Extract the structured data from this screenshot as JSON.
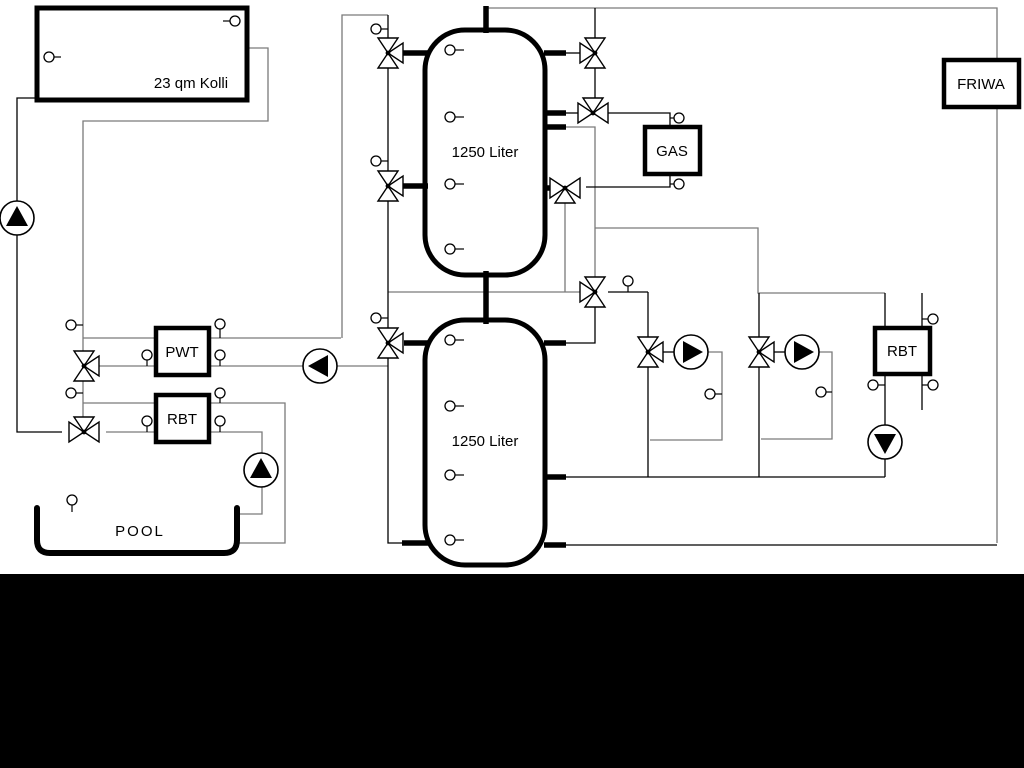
{
  "title": "Hydraulic scheme",
  "colors": {
    "black": "#000000",
    "gray": "#7a7a7a",
    "white": "#ffffff",
    "bar": "#000000"
  },
  "bottom_bar": {
    "x": 0,
    "y": 574,
    "w": 1024,
    "h": 194
  },
  "labels": {
    "collector": "23 qm Kolli",
    "tank1": "1250 Liter",
    "tank2": "1250 Liter",
    "gas": "GAS",
    "friwa": "FRIWA",
    "pwt": "PWT",
    "rbt_left": "RBT",
    "rbt_right": "RBT",
    "pool": "POOL"
  },
  "diagram": {
    "lines": [
      {
        "name": "solar-return-line",
        "color": "gray",
        "pts": [
          [
            247,
            48
          ],
          [
            268,
            48
          ],
          [
            268,
            121
          ],
          [
            83,
            121
          ],
          [
            83,
            418
          ]
        ]
      },
      {
        "name": "tank1-top-feed-line",
        "color": "gray",
        "pts": [
          [
            388,
            15
          ],
          [
            342,
            15
          ],
          [
            342,
            338
          ]
        ]
      },
      {
        "name": "pwt-top-line",
        "color": "gray",
        "pts": [
          [
            83,
            338
          ],
          [
            341,
            338
          ]
        ]
      },
      {
        "name": "pwt-bottom-line",
        "color": "gray",
        "pts": [
          [
            99,
            366
          ],
          [
            388,
            366
          ]
        ]
      },
      {
        "name": "rbt-top-line",
        "color": "gray",
        "pts": [
          [
            83,
            403
          ],
          [
            285,
            403
          ],
          [
            285,
            543
          ],
          [
            237,
            543
          ]
        ]
      },
      {
        "name": "rbt-bottom-pool-line",
        "color": "gray",
        "pts": [
          [
            106,
            432
          ],
          [
            262,
            432
          ],
          [
            262,
            514
          ],
          [
            238,
            514
          ]
        ]
      },
      {
        "name": "main-top-friwa-line",
        "color": "gray",
        "pts": [
          [
            486,
            8
          ],
          [
            997,
            8
          ],
          [
            997,
            543
          ]
        ]
      },
      {
        "name": "secondary-supply-line",
        "color": "gray",
        "pts": [
          [
            388,
            292
          ],
          [
            580,
            292
          ]
        ]
      },
      {
        "name": "gas-return-drop-line",
        "color": "gray",
        "pts": [
          [
            565,
            202
          ],
          [
            565,
            292
          ]
        ]
      },
      {
        "name": "tank1-right-drop-line",
        "color": "gray",
        "pts": [
          [
            566,
            127
          ],
          [
            595,
            127
          ],
          [
            595,
            278
          ]
        ]
      },
      {
        "name": "heating-branch-line",
        "color": "gray",
        "pts": [
          [
            595,
            228
          ],
          [
            758,
            228
          ],
          [
            758,
            293
          ],
          [
            885,
            293
          ]
        ]
      },
      {
        "name": "heating1-bypass-loop",
        "color": "gray",
        "pts": [
          [
            708,
            352
          ],
          [
            722,
            352
          ],
          [
            722,
            440
          ],
          [
            650,
            440
          ]
        ]
      },
      {
        "name": "heating2-bypass-loop",
        "color": "gray",
        "pts": [
          [
            819,
            352
          ],
          [
            832,
            352
          ],
          [
            832,
            439
          ],
          [
            761,
            439
          ]
        ]
      },
      {
        "name": "solar-supply-line",
        "color": "black",
        "pts": [
          [
            37,
            98
          ],
          [
            17,
            98
          ],
          [
            17,
            432
          ],
          [
            62,
            432
          ]
        ]
      },
      {
        "name": "tank-left-riser-line",
        "color": "black",
        "pts": [
          [
            388,
            15
          ],
          [
            388,
            543
          ],
          [
            404,
            543
          ]
        ]
      },
      {
        "name": "tank1-valve-a-stub-line",
        "color": "black",
        "pts": [
          [
            566,
            53
          ],
          [
            581,
            53
          ]
        ]
      },
      {
        "name": "valve-a-top-line",
        "color": "black",
        "pts": [
          [
            595,
            8
          ],
          [
            595,
            38
          ]
        ]
      },
      {
        "name": "valve-a-b-line",
        "color": "black",
        "pts": [
          [
            595,
            68
          ],
          [
            595,
            98
          ]
        ]
      },
      {
        "name": "tank1-valve-b-stub-line",
        "color": "black",
        "pts": [
          [
            566,
            113
          ],
          [
            578,
            113
          ]
        ]
      },
      {
        "name": "gas-supply-line",
        "color": "black",
        "pts": [
          [
            608,
            113
          ],
          [
            670,
            113
          ],
          [
            670,
            127
          ]
        ]
      },
      {
        "name": "gas-return-line",
        "color": "black",
        "pts": [
          [
            670,
            174
          ],
          [
            670,
            187
          ],
          [
            586,
            187
          ]
        ]
      },
      {
        "name": "mixing-to-heating1-line",
        "color": "black",
        "pts": [
          [
            608,
            292
          ],
          [
            648,
            292
          ]
        ]
      },
      {
        "name": "heating1-riser-line",
        "color": "black",
        "pts": [
          [
            648,
            292
          ],
          [
            648,
            477
          ]
        ]
      },
      {
        "name": "heating2-riser-line",
        "color": "black",
        "pts": [
          [
            759,
            293
          ],
          [
            759,
            477
          ]
        ]
      },
      {
        "name": "mixing-to-tank2-line",
        "color": "black",
        "pts": [
          [
            595,
            307
          ],
          [
            595,
            343
          ],
          [
            546,
            343
          ]
        ]
      },
      {
        "name": "return-header-line",
        "color": "black",
        "pts": [
          [
            548,
            477
          ],
          [
            885,
            477
          ]
        ]
      },
      {
        "name": "rbt2-pump-line",
        "color": "black",
        "pts": [
          [
            885,
            374
          ],
          [
            885,
            477
          ]
        ]
      },
      {
        "name": "rbt2-top-line",
        "color": "black",
        "pts": [
          [
            885,
            293
          ],
          [
            885,
            328
          ]
        ]
      },
      {
        "name": "friwa-return-line",
        "color": "black",
        "pts": [
          [
            548,
            545
          ],
          [
            997,
            545
          ]
        ]
      },
      {
        "name": "heating1-valve-pump-line",
        "color": "black",
        "pts": [
          [
            661,
            352
          ],
          [
            674,
            352
          ]
        ]
      },
      {
        "name": "heating2-valve-pump-line",
        "color": "black",
        "pts": [
          [
            772,
            352
          ],
          [
            785,
            352
          ]
        ]
      },
      {
        "name": "rbt2-secondary-line",
        "color": "black",
        "pts": [
          [
            922,
            293
          ],
          [
            922,
            410
          ]
        ]
      }
    ],
    "stubs": [
      {
        "name": "tank1-stub-w-top",
        "x1": 400,
        "y1": 53,
        "x2": 428,
        "y2": 53
      },
      {
        "name": "tank1-stub-w-mid",
        "x1": 400,
        "y1": 186,
        "x2": 428,
        "y2": 186
      },
      {
        "name": "tank1-stub-e-top",
        "x1": 544,
        "y1": 53,
        "x2": 566,
        "y2": 53
      },
      {
        "name": "tank1-stub-e-mid1",
        "x1": 544,
        "y1": 113,
        "x2": 566,
        "y2": 113
      },
      {
        "name": "tank1-stub-e-mid2",
        "x1": 544,
        "y1": 127,
        "x2": 566,
        "y2": 127
      },
      {
        "name": "tank1-stub-e-low",
        "x1": 544,
        "y1": 188,
        "x2": 554,
        "y2": 188
      },
      {
        "name": "tank1-top-pipe",
        "x1": 486,
        "y1": 6,
        "x2": 486,
        "y2": 33
      },
      {
        "name": "inter-tank-pipe",
        "x1": 486,
        "y1": 271,
        "x2": 486,
        "y2": 324
      },
      {
        "name": "tank2-stub-w-top",
        "x1": 404,
        "y1": 343,
        "x2": 428,
        "y2": 343
      },
      {
        "name": "tank2-stub-w-bottom",
        "x1": 402,
        "y1": 543,
        "x2": 428,
        "y2": 543
      },
      {
        "name": "tank2-stub-e-top",
        "x1": 544,
        "y1": 343,
        "x2": 566,
        "y2": 343
      },
      {
        "name": "tank2-stub-e-mid",
        "x1": 544,
        "y1": 477,
        "x2": 566,
        "y2": 477
      },
      {
        "name": "tank2-stub-e-bottom",
        "x1": 544,
        "y1": 545,
        "x2": 566,
        "y2": 545
      }
    ],
    "boxes": [
      {
        "name": "collector-box",
        "x": 37,
        "y": 8,
        "w": 210,
        "h": 92,
        "sw": 5,
        "bind": "labels.collector",
        "lx": 191,
        "ly": 88,
        "fs": 15
      },
      {
        "name": "pwt-box",
        "x": 156,
        "y": 328,
        "w": 53,
        "h": 47,
        "sw": 4.5,
        "bind": "labels.pwt",
        "lx": 182,
        "ly": 357,
        "fs": 15
      },
      {
        "name": "rbt-left-box",
        "x": 156,
        "y": 395,
        "w": 53,
        "h": 47,
        "sw": 4.5,
        "bind": "labels.rbt_left",
        "lx": 182,
        "ly": 424,
        "fs": 15
      },
      {
        "name": "gas-boiler-box",
        "x": 645,
        "y": 127,
        "w": 55,
        "h": 47,
        "sw": 4.5,
        "bind": "labels.gas",
        "lx": 672,
        "ly": 156,
        "fs": 15
      },
      {
        "name": "friwa-box",
        "x": 944,
        "y": 60,
        "w": 75,
        "h": 47,
        "sw": 4.5,
        "bind": "labels.friwa",
        "lx": 981,
        "ly": 89,
        "fs": 15
      },
      {
        "name": "rbt-right-box",
        "x": 875,
        "y": 328,
        "w": 55,
        "h": 46,
        "sw": 4.5,
        "bind": "labels.rbt_right",
        "lx": 902,
        "ly": 356,
        "fs": 15
      }
    ],
    "tanks": [
      {
        "name": "buffer-tank-1",
        "x": 425,
        "y": 30,
        "w": 120,
        "h": 245,
        "rx": 40,
        "sw": 5,
        "bind": "labels.tank1",
        "lx": 485,
        "ly": 157,
        "fs": 15
      },
      {
        "name": "buffer-tank-2",
        "x": 425,
        "y": 320,
        "w": 120,
        "h": 245,
        "rx": 40,
        "sw": 5,
        "bind": "labels.tank2",
        "lx": 485,
        "ly": 446,
        "fs": 15
      }
    ],
    "pool": {
      "name": "pool-basin",
      "path": "M 37 508 L 37 540 Q 37 553 50 553 L 224 553 Q 237 553 237 540 L 237 508",
      "sw": 6,
      "bind": "labels.pool",
      "lx": 140,
      "ly": 536,
      "fs": 15
    },
    "valves": [
      {
        "name": "valve-tank1-top-left",
        "x": 388,
        "y": 53,
        "o": "v",
        "e": "E"
      },
      {
        "name": "valve-tank1-mid-left",
        "x": 388,
        "y": 186,
        "o": "v",
        "e": "E"
      },
      {
        "name": "valve-tank2-top-left",
        "x": 388,
        "y": 343,
        "o": "v",
        "e": "E"
      },
      {
        "name": "valve-solar-pwt",
        "x": 84,
        "y": 366,
        "o": "v",
        "e": "E"
      },
      {
        "name": "valve-solar-pool",
        "x": 84,
        "y": 432,
        "o": "h",
        "e": "N"
      },
      {
        "name": "valve-tank1-top-right",
        "x": 595,
        "y": 53,
        "o": "v",
        "e": "W"
      },
      {
        "name": "valve-gas-supply",
        "x": 593,
        "y": 113,
        "o": "h",
        "e": "N"
      },
      {
        "name": "valve-gas-return",
        "x": 565,
        "y": 188,
        "o": "h",
        "e": "S"
      },
      {
        "name": "valve-mixing-center",
        "x": 595,
        "y": 292,
        "o": "v",
        "e": "W"
      },
      {
        "name": "valve-heating-circuit-1",
        "x": 648,
        "y": 352,
        "o": "v",
        "e": "E"
      },
      {
        "name": "valve-heating-circuit-2",
        "x": 759,
        "y": 352,
        "o": "v",
        "e": "E"
      }
    ],
    "pumps": [
      {
        "name": "solar-pump",
        "x": 17,
        "y": 218,
        "d": "N"
      },
      {
        "name": "pwt-secondary-pump",
        "x": 320,
        "y": 366,
        "d": "W"
      },
      {
        "name": "pool-pump",
        "x": 261,
        "y": 470,
        "d": "N"
      },
      {
        "name": "heating-pump-1",
        "x": 691,
        "y": 352,
        "d": "E"
      },
      {
        "name": "heating-pump-2",
        "x": 802,
        "y": 352,
        "d": "E"
      },
      {
        "name": "rbt2-pump",
        "x": 885,
        "y": 442,
        "d": "S"
      }
    ],
    "sensors": [
      {
        "name": "collector-sensor-left",
        "x": 49,
        "y": 57,
        "px": 61,
        "py": 57
      },
      {
        "name": "collector-sensor-right",
        "x": 235,
        "y": 21,
        "px": 223,
        "py": 21
      },
      {
        "name": "tank1-sensor-1",
        "x": 450,
        "y": 50,
        "px": 464,
        "py": 50
      },
      {
        "name": "tank1-sensor-2",
        "x": 450,
        "y": 117,
        "px": 464,
        "py": 117
      },
      {
        "name": "tank1-sensor-3",
        "x": 450,
        "y": 184,
        "px": 464,
        "py": 184
      },
      {
        "name": "tank1-sensor-4",
        "x": 450,
        "y": 249,
        "px": 464,
        "py": 249
      },
      {
        "name": "tank2-sensor-1",
        "x": 450,
        "y": 340,
        "px": 464,
        "py": 340
      },
      {
        "name": "tank2-sensor-2",
        "x": 450,
        "y": 406,
        "px": 464,
        "py": 406
      },
      {
        "name": "tank2-sensor-3",
        "x": 450,
        "y": 475,
        "px": 464,
        "py": 475
      },
      {
        "name": "tank2-sensor-4",
        "x": 450,
        "y": 540,
        "px": 464,
        "py": 540
      },
      {
        "name": "riser-sensor-top",
        "x": 376,
        "y": 29,
        "px": 388,
        "py": 29
      },
      {
        "name": "riser-sensor-mid",
        "x": 376,
        "y": 161,
        "px": 388,
        "py": 161
      },
      {
        "name": "riser-sensor-low",
        "x": 376,
        "y": 318,
        "px": 388,
        "py": 318
      },
      {
        "name": "solar-line-sensor-1",
        "x": 71,
        "y": 325,
        "px": 83,
        "py": 325
      },
      {
        "name": "solar-line-sensor-2",
        "x": 71,
        "y": 393,
        "px": 83,
        "py": 393
      },
      {
        "name": "pool-sensor",
        "x": 72,
        "y": 500,
        "px": 72,
        "py": 512
      },
      {
        "name": "pwt-bottom-sensor-left",
        "x": 147,
        "y": 355,
        "px": 147,
        "py": 366
      },
      {
        "name": "pwt-top-sensor-right",
        "x": 220,
        "y": 324,
        "px": 220,
        "py": 338
      },
      {
        "name": "pwt-bottom-sensor-right",
        "x": 220,
        "y": 355,
        "px": 220,
        "py": 366
      },
      {
        "name": "rbt-top-sensor-right",
        "x": 220,
        "y": 393,
        "px": 220,
        "py": 403
      },
      {
        "name": "rbt-bottom-sensor-left",
        "x": 147,
        "y": 421,
        "px": 147,
        "py": 432
      },
      {
        "name": "rbt-bottom-sensor-right",
        "x": 220,
        "y": 421,
        "px": 220,
        "py": 432
      },
      {
        "name": "mixing-line-sensor",
        "x": 628,
        "y": 281,
        "px": 628,
        "py": 292
      },
      {
        "name": "gas-supply-sensor",
        "x": 679,
        "y": 118,
        "px": 670,
        "py": 118
      },
      {
        "name": "gas-return-sensor",
        "x": 679,
        "y": 184,
        "px": 670,
        "py": 184
      },
      {
        "name": "heating1-loop-sensor",
        "x": 710,
        "y": 394,
        "px": 722,
        "py": 394
      },
      {
        "name": "heating2-loop-sensor",
        "x": 821,
        "y": 392,
        "px": 832,
        "py": 392
      },
      {
        "name": "rbt2-return-sensor",
        "x": 873,
        "y": 385,
        "px": 885,
        "py": 385
      },
      {
        "name": "rbt2-secondary-sensor-top",
        "x": 933,
        "y": 319,
        "px": 922,
        "py": 319
      },
      {
        "name": "rbt2-secondary-sensor-bottom",
        "x": 933,
        "y": 385,
        "px": 922,
        "py": 385
      }
    ]
  }
}
